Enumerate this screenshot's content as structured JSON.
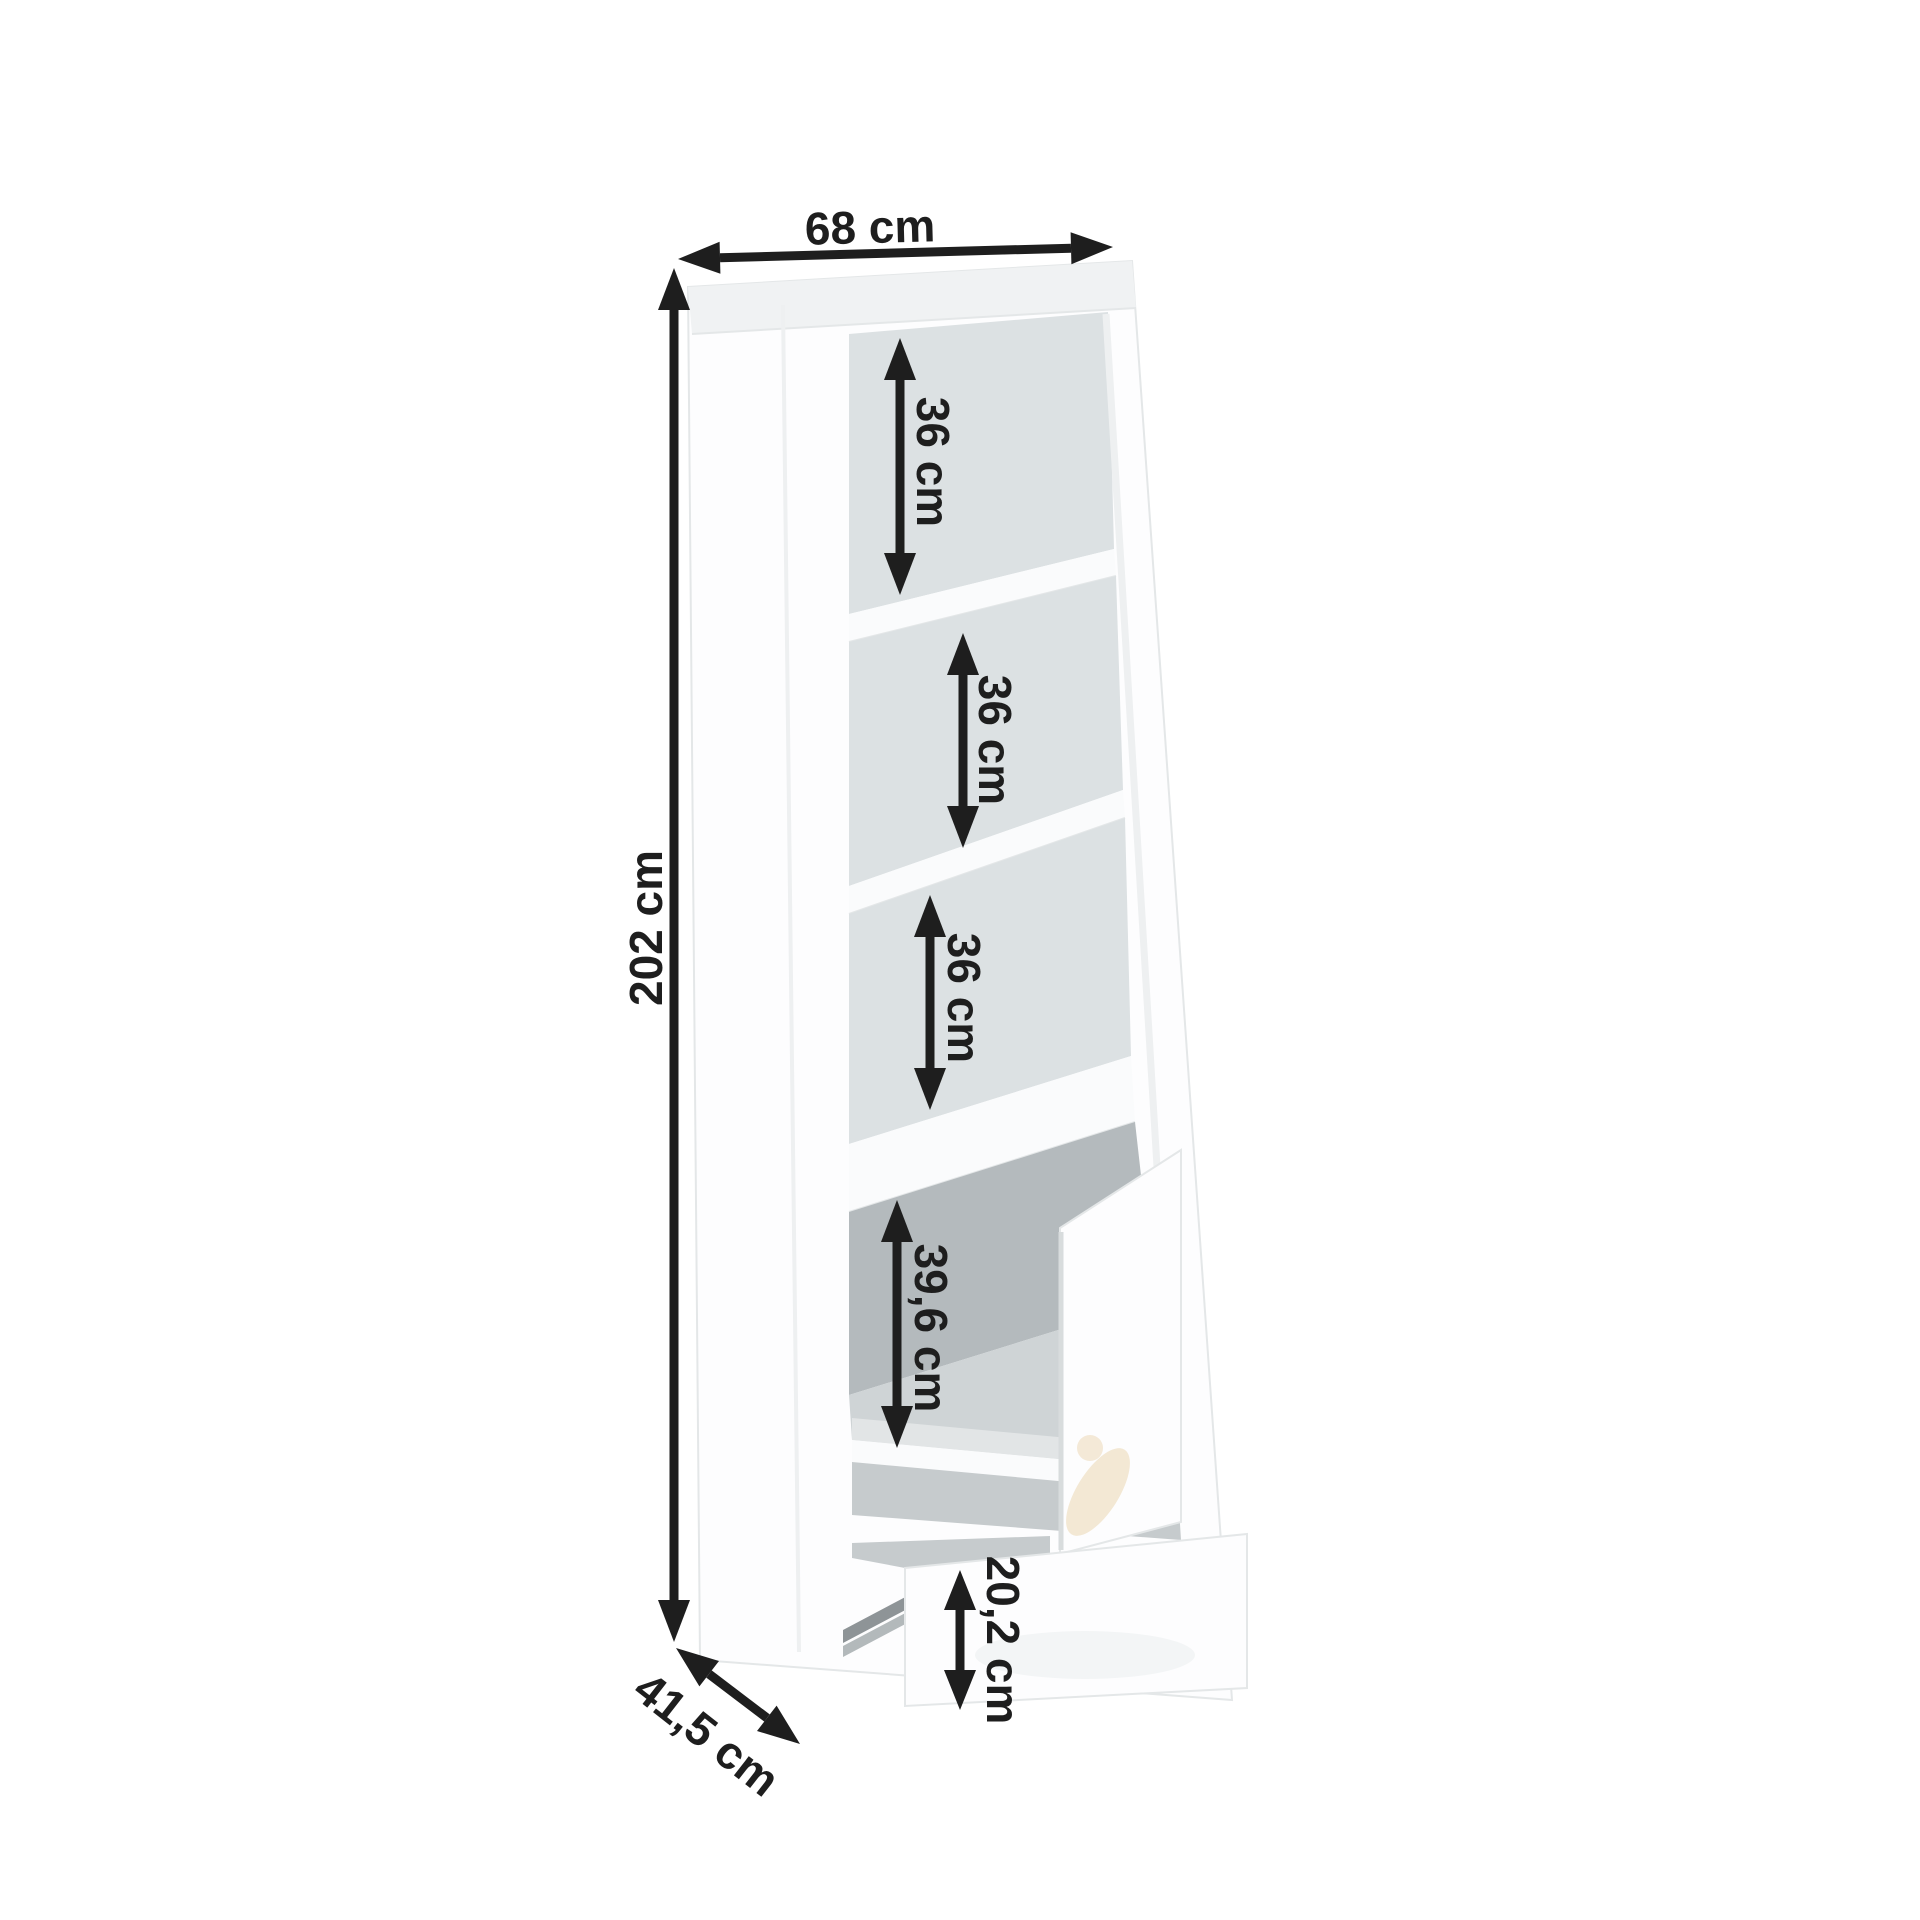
{
  "page": {
    "background": "#ffffff"
  },
  "colors": {
    "page": "#ffffff",
    "arrow": "#1e1e1e",
    "cabinet": "#fdfdfe",
    "cabinet_edge": "#e4e7e8",
    "top_slab": "#f0f2f3",
    "interior": "#dce1e3",
    "interior_dark": "#b4babd",
    "interior_mid": "#cfd4d6",
    "interior_floor": "#e2e5e6",
    "shelf": "#fafbfc",
    "cavity": "#c6cbcd",
    "slide_dark": "#8e9497",
    "slide_light": "#b3b9bb",
    "handle_reflection": "#f1e4cd"
  },
  "dimensions": {
    "width": {
      "label": "68 cm"
    },
    "height": {
      "label": "202 cm"
    },
    "depth": {
      "label": "41,5 cm"
    },
    "shelves": [
      {
        "label": "36 cm"
      },
      {
        "label": "36 cm"
      },
      {
        "label": "36 cm"
      }
    ],
    "door_compartment": {
      "label": "39,6 cm"
    },
    "drawer": {
      "label": "20,2 cm"
    }
  }
}
